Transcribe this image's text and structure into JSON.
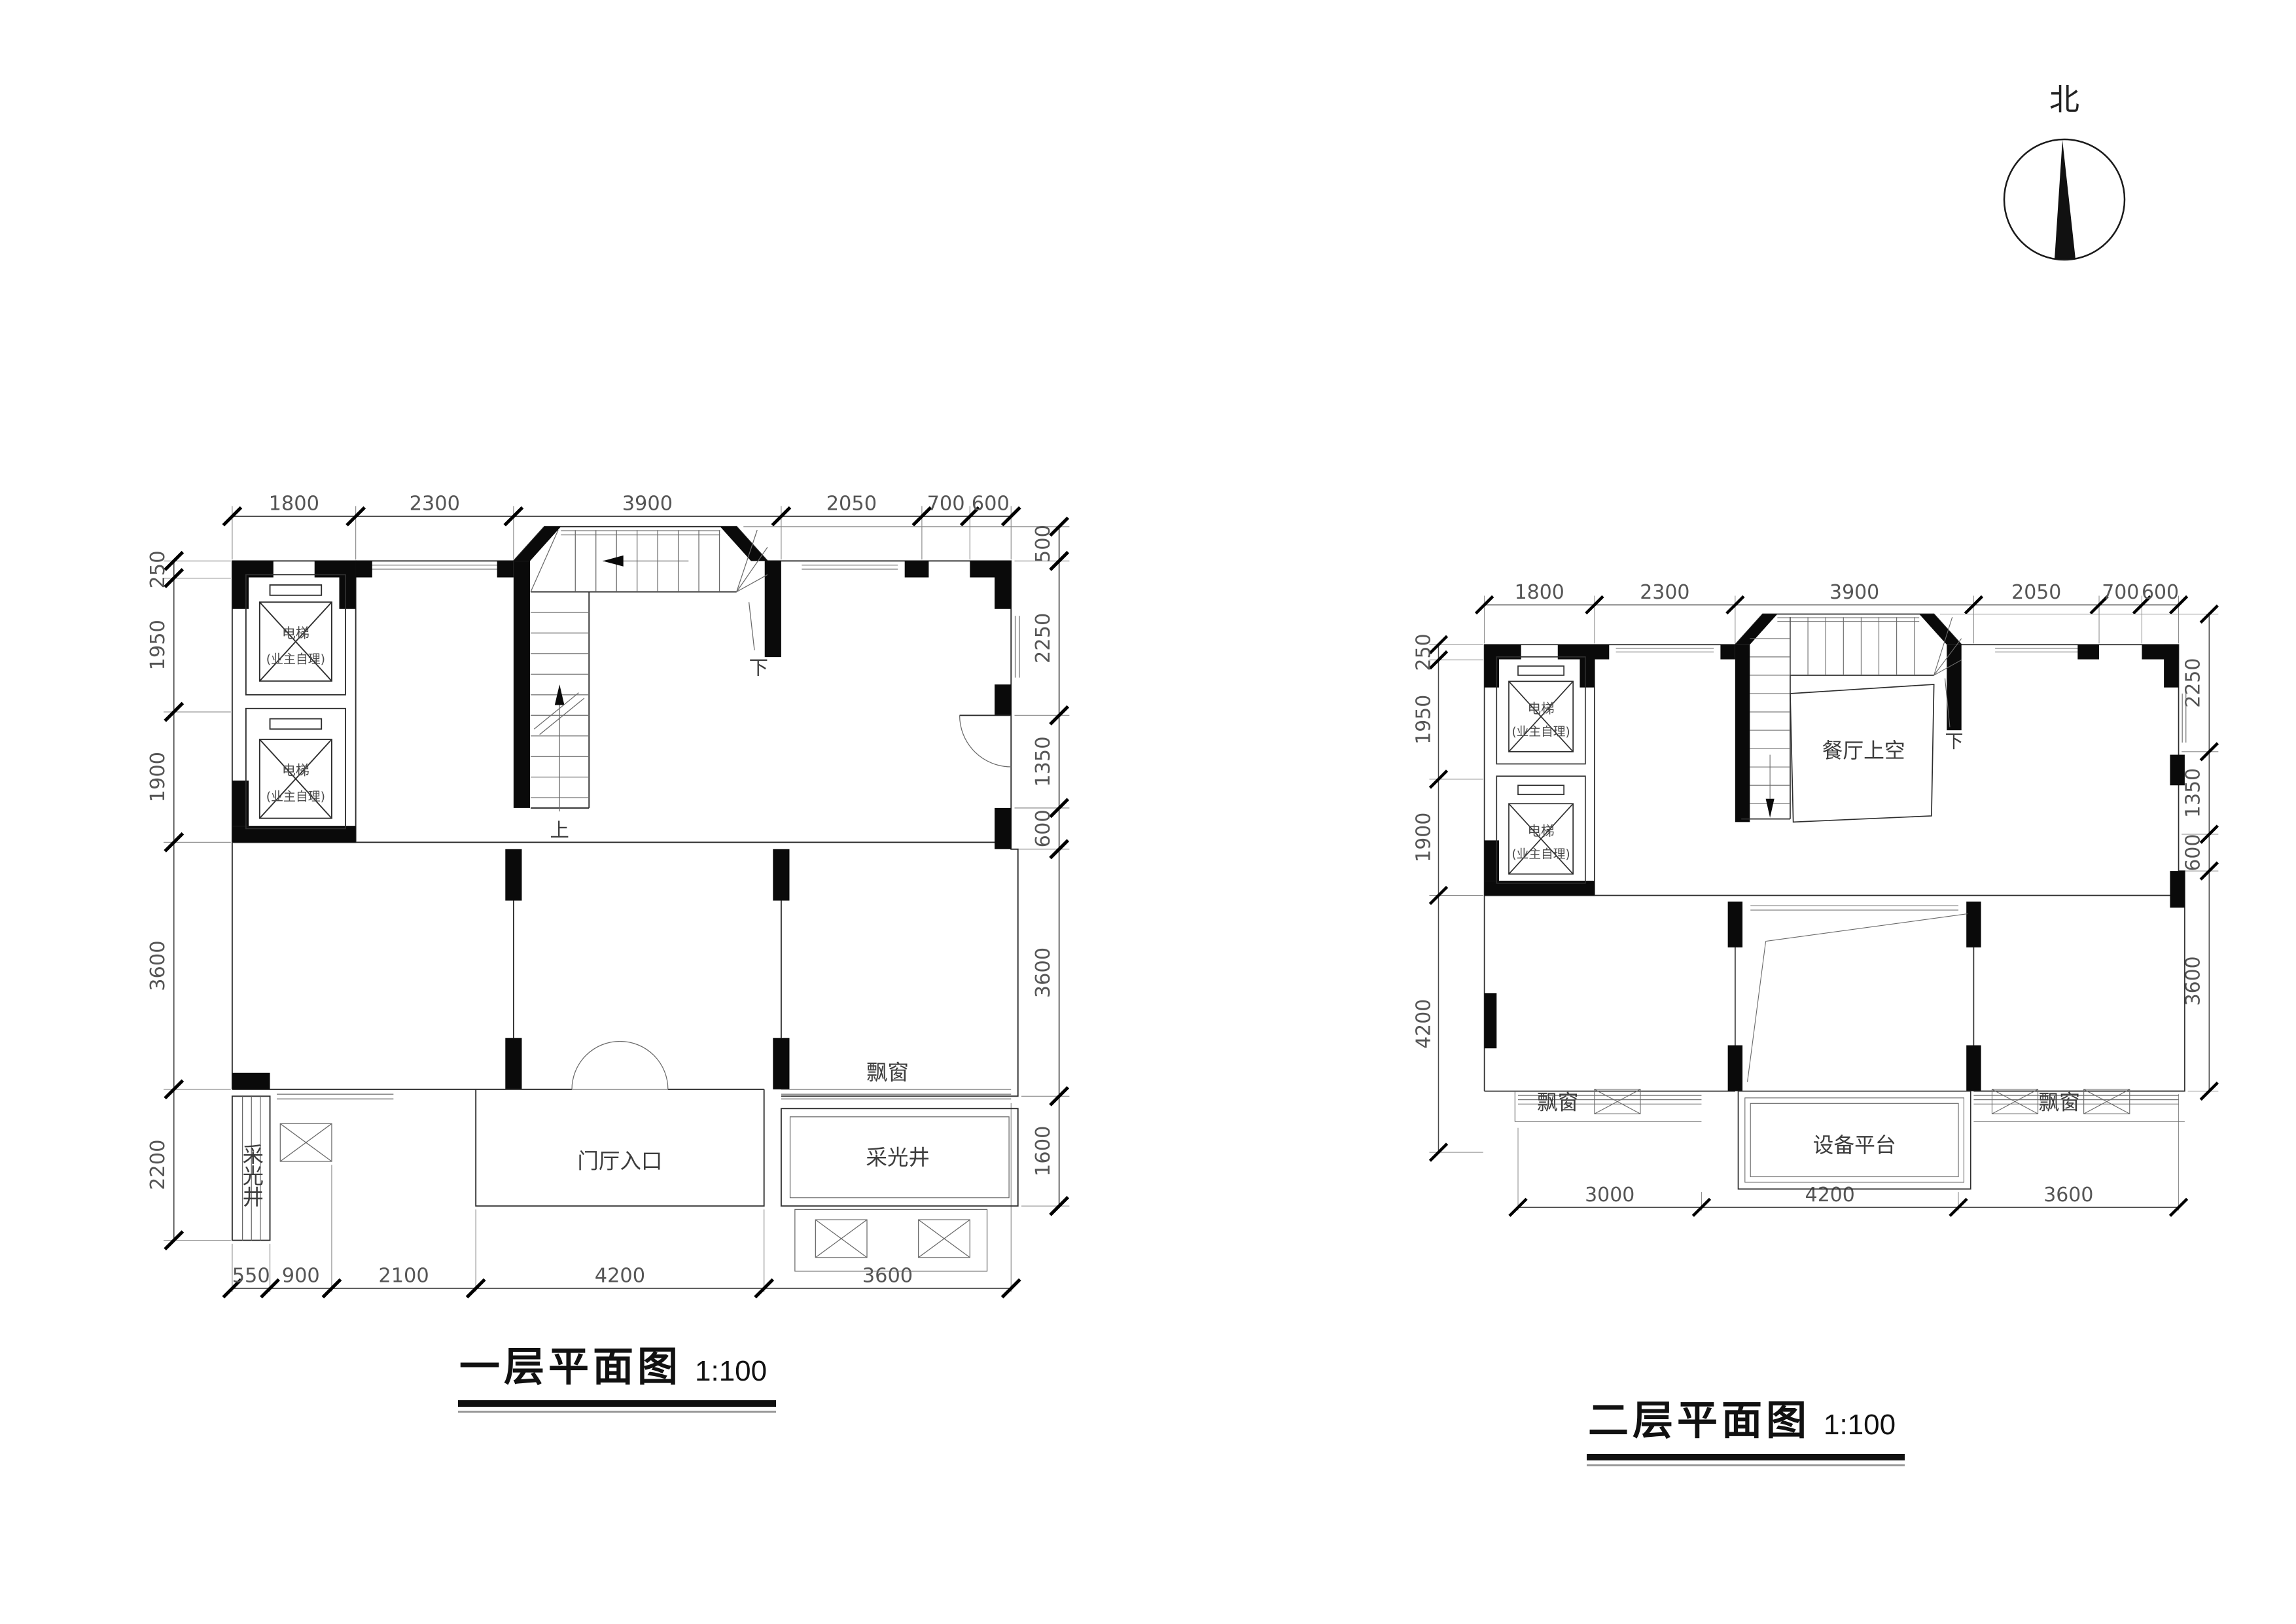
{
  "sheet": {
    "background": "#ffffff",
    "line_color": "#2e2e2e",
    "wall_color": "#0a0a0a"
  },
  "north": {
    "label": "北"
  },
  "plan1": {
    "title": "一层平面图",
    "scale": "1:100",
    "dims": {
      "top": [
        "1800",
        "2300",
        "3900",
        "2050",
        "700",
        "600"
      ],
      "left": [
        "250",
        "1950",
        "1900",
        "3600",
        "2200"
      ],
      "right": [
        "500",
        "2250",
        "1350",
        "600",
        "3600",
        "1600"
      ],
      "bottom": [
        "550",
        "900",
        "2100",
        "4200",
        "3600"
      ]
    },
    "labels": {
      "elevator": "电梯",
      "elevator_note": "(业主自理)",
      "up": "上",
      "down": "下",
      "entry": "门厅入口",
      "bay_window": "飘窗",
      "light_well_left": "采光井",
      "light_well_right": "采光井"
    }
  },
  "plan2": {
    "title": "二层平面图",
    "scale": "1:100",
    "dims": {
      "top": [
        "1800",
        "2300",
        "3900",
        "2050",
        "700",
        "600"
      ],
      "left": [
        "250",
        "1950",
        "1900",
        "4200"
      ],
      "right": [
        "2250",
        "1350",
        "600",
        "3600"
      ],
      "bottom": [
        "3000",
        "4200",
        "3600"
      ]
    },
    "labels": {
      "elevator": "电梯",
      "elevator_note": "(业主自理)",
      "down": "下",
      "dining_void": "餐厅上空",
      "equipment_platform": "设备平台",
      "bay_window_left": "飘窗",
      "bay_window_right": "飘窗"
    }
  }
}
